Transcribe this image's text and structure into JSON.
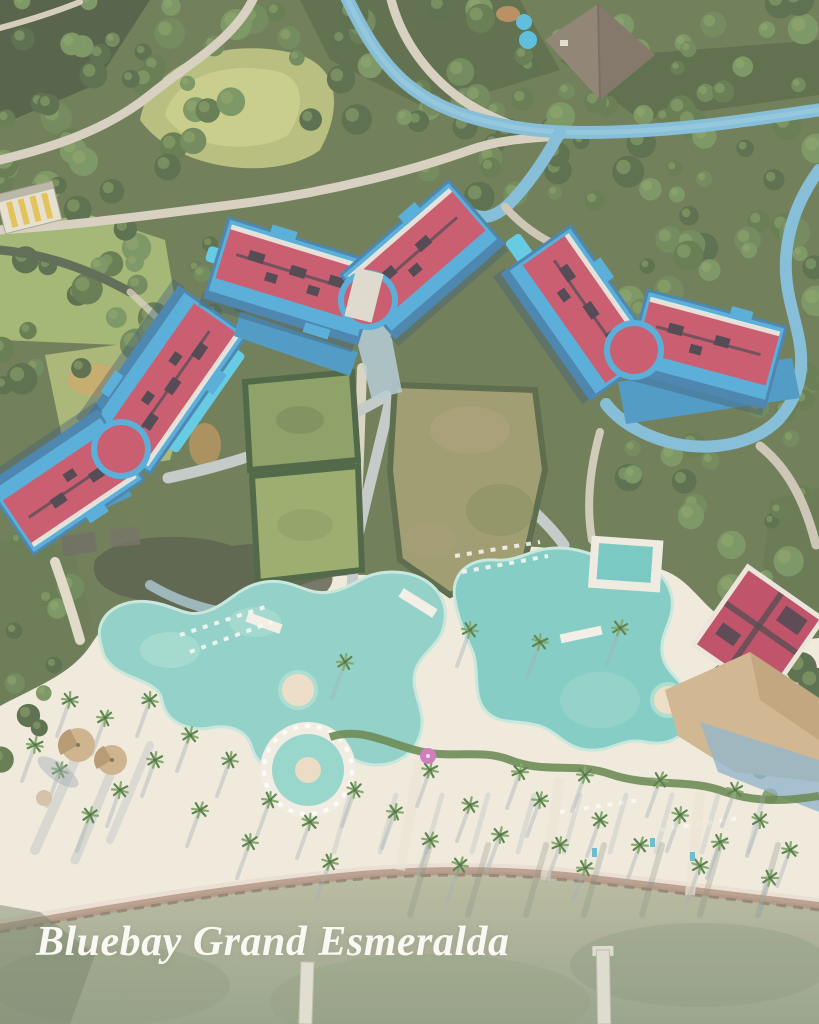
{
  "caption": {
    "text": "Bluebay Grand Esmeralda",
    "color": "#faf8f2"
  },
  "scene": {
    "type": "aerial-drone-photo-of-beach-resort",
    "visible_features": {
      "hotel_buildings_red_roof": 3,
      "freeform_pools": 2,
      "round_pool": 1,
      "lap_pools": 3,
      "piers": 2,
      "beach": "white sand with palms and long shadows",
      "sea": "shallow khaki-green water at bottom"
    }
  },
  "palette": {
    "forest_base": "#55683c",
    "forest_dark": "#36462a",
    "tree_greens": [
      "#3f5630",
      "#4c6636",
      "#587441",
      "#66844a"
    ],
    "tree_highlight": "#7d9a55",
    "lawn_lime": "#b5bd6e",
    "roof_red": "#c23f58",
    "trim_blue": "#3aa0d4",
    "trim_blue_dark": "#2a6fa3",
    "lap_pool_cyan": "#48c2e2",
    "road_blue": "#6fb1d4",
    "path_light": "#cfc6b4",
    "deck_sand": "#eee7da",
    "pool_water": "#7ecac2",
    "island_sand": "#ead9bf",
    "hedge_green": "#517436",
    "seaweed": "#a5826e",
    "ocean_top": "#b0b193",
    "ocean_bottom": "#87947a",
    "shadow_blue": "#93a3ac",
    "thatch_tan": "#c6a77c",
    "white_trim": "#eceadf"
  }
}
